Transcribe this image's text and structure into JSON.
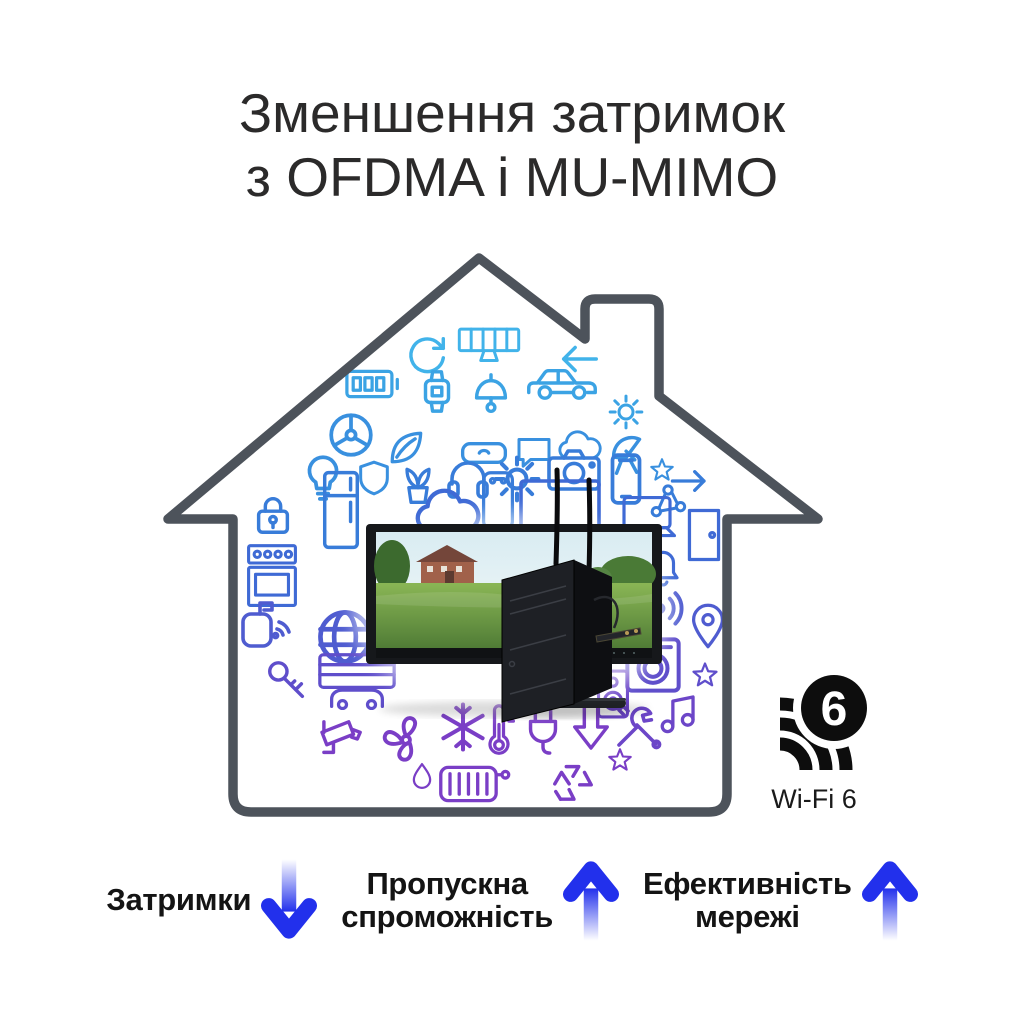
{
  "title": {
    "line1": "Зменшення затримок",
    "line2": "з OFDMA і MU-MIMO"
  },
  "wifi6_badge": {
    "number": "6",
    "label": "Wi-Fi 6"
  },
  "devices": {
    "monitor_brand": "ASUS"
  },
  "metrics": [
    {
      "label": "Затримки",
      "direction": "down"
    },
    {
      "line1": "Пропускна",
      "line2": "спроможність",
      "direction": "up"
    },
    {
      "line1": "Ефективність",
      "line2": "мережі",
      "direction": "up"
    }
  ],
  "colors": {
    "arrow_blue": "#2230ec",
    "house_outline": "#4d535b",
    "icon_gradient_top": "#41b3ea",
    "icon_gradient_bottom": "#7a3ec6",
    "title_text": "#2b2a2a",
    "label_text": "#141414"
  },
  "icon_cluster": [
    "sync-arrow",
    "solar-panel",
    "arrow-left",
    "battery",
    "smart-watch",
    "hanging-lamp",
    "car",
    "gear",
    "radiation-fan",
    "leaf",
    "vr-glasses",
    "chat-bubble",
    "cloud",
    "satellite-dish",
    "star",
    "light-bulb",
    "shield",
    "potted-plant",
    "headphones",
    "camera",
    "smartphone",
    "network-nodes",
    "lock",
    "refrigerator",
    "water-heater",
    "cloud-large",
    "tv",
    "laptop",
    "door",
    "arrow-right",
    "bell",
    "wifi-antenna",
    "location-pin",
    "washing-machine",
    "speaker",
    "stove",
    "mailbox",
    "globe",
    "key",
    "garage",
    "security-camera",
    "wind-turbine",
    "water-drop",
    "snowflake",
    "thermometer",
    "power-plug",
    "arrow-down",
    "tools",
    "music-note",
    "radiator",
    "recycle"
  ]
}
